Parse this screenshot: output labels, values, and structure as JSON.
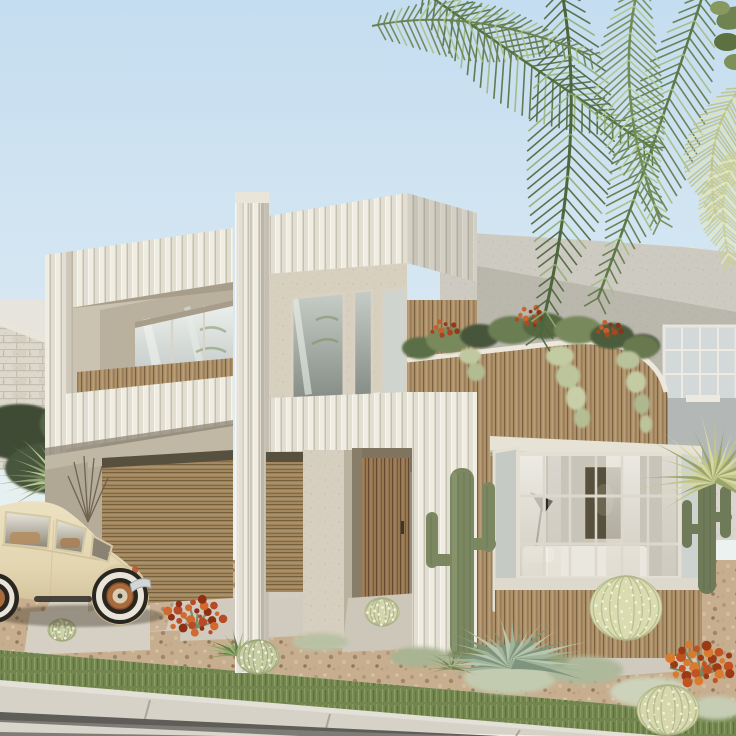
{
  "scene": {
    "type": "architectural-render",
    "description": "Modern two-storey coastal house with white fluted panels, timber slat cladding, recessed balcony, double garage, bay window, desert gravel garden with cacti and agaves, palm fronds overhead and a cream vintage Beetle parked on the driveway",
    "elements": [
      "sky",
      "palm-fronds",
      "neighbour-building-right",
      "brick-wall-left",
      "rear-grey-wall",
      "left-wing-balcony",
      "central-fluted-column",
      "right-wing-parapet",
      "wood-clad-volume",
      "rooftop-garden",
      "garage-doors",
      "entry-door",
      "bay-window",
      "gravel-garden",
      "driveway",
      "lawn-strip",
      "sidewalk",
      "road",
      "saguaro-cactus",
      "agave",
      "barrel-cactus",
      "vintage-beetle-car"
    ]
  },
  "palette": {
    "sky_top": "#c4ddf0",
    "sky_horizon": "#f1f1ea",
    "flute_light": "#efece2",
    "flute_groove": "#c6c0b0",
    "stucco_beige": "#d5cebd",
    "stucco_beige_shade": "#b9b09d",
    "stucco_grey": "#cdcac1",
    "stucco_grey_shade": "#b5b1a8",
    "wood_mid": "#a98d66",
    "wood_dark": "#7a6142",
    "wood_door": "#8f7350",
    "glass_light": "#eef1ef",
    "glass_dark": "#a9b0ab",
    "palm_dark": "#4e663c",
    "palm_light": "#bec487",
    "car_body": "#e4d7b4",
    "rim_copper": "#a86b3c",
    "gravel": "#c7ae8f",
    "concrete": "#d2cdc0",
    "grass": "#73864f",
    "road": "#7e7c76",
    "cactus": "#7b8761",
    "agave": "#9fb49b",
    "flower_red": "#b84a28"
  },
  "generators": {
    "fronds": [
      {
        "p0": [
          418,
          -12
        ],
        "c": [
          515,
          55
        ],
        "p1": [
          652,
          148
        ],
        "len": 40,
        "color": "#56713f",
        "hi": "#9db77e",
        "lw": 2.5
      },
      {
        "p0": [
          560,
          -18
        ],
        "c": [
          590,
          130
        ],
        "p1": [
          540,
          335
        ],
        "len": 46,
        "color": "#4e663c",
        "hi": "#8fae73",
        "lw": 3
      },
      {
        "p0": [
          705,
          -12
        ],
        "c": [
          662,
          125
        ],
        "p1": [
          598,
          298
        ],
        "len": 42,
        "color": "#5f7847",
        "hi": "#a3bc82",
        "lw": 2.5
      },
      {
        "p0": [
          742,
          85
        ],
        "c": [
          700,
          138
        ],
        "p1": [
          716,
          215
        ],
        "len": 30,
        "color": "#bec487",
        "hi": "#e0e2ae",
        "lw": 2
      },
      {
        "p0": [
          372,
          26
        ],
        "c": [
          470,
          5
        ],
        "p1": [
          590,
          55
        ],
        "len": 30,
        "color": "#6a8150",
        "hi": "#a8bf85",
        "lw": 2
      },
      {
        "p0": [
          640,
          -20
        ],
        "c": [
          610,
          90
        ],
        "p1": [
          660,
          220
        ],
        "len": 36,
        "color": "#728b55",
        "hi": "#b0c68c",
        "lw": 2.5
      },
      {
        "p0": [
          741,
          150
        ],
        "c": [
          712,
          190
        ],
        "p1": [
          730,
          262
        ],
        "len": 24,
        "color": "#cbcf9a",
        "hi": "#e6e7bb",
        "lw": 2
      }
    ],
    "rosettes": [
      {
        "target": "rosette-agave-main",
        "cx": 513,
        "cy": 664,
        "n": 26,
        "rmin": 38,
        "rmax": 92,
        "a0": 200,
        "a1": -20,
        "squash": 0.55,
        "w": 11,
        "colors": [
          "#9fb49b",
          "#7e947c",
          "#b7c6ae"
        ]
      },
      {
        "target": "rosette-agave-small",
        "cx": 238,
        "cy": 654,
        "n": 16,
        "rmin": 18,
        "rmax": 44,
        "a0": 195,
        "a1": -15,
        "squash": 0.6,
        "w": 5,
        "colors": [
          "#87a065",
          "#647c49",
          "#9db377"
        ]
      },
      {
        "target": "rosette-yucca-left",
        "cx": 60,
        "cy": 480,
        "n": 24,
        "rmin": 30,
        "rmax": 74,
        "a0": 215,
        "a1": -35,
        "squash": 0.8,
        "w": 6,
        "colors": [
          "#93a377",
          "#6d7f55",
          "#b8c491"
        ]
      },
      {
        "target": "rosette-yucca-right",
        "cx": 716,
        "cy": 480,
        "n": 26,
        "rmin": 36,
        "rmax": 88,
        "a0": 215,
        "a1": -35,
        "squash": 0.85,
        "w": 6,
        "colors": [
          "#c2c68c",
          "#98a566",
          "#d6d7a3"
        ]
      },
      {
        "target": "rosette-grass-1",
        "cx": 452,
        "cy": 668,
        "n": 14,
        "rmin": 14,
        "rmax": 34,
        "a0": 200,
        "a1": -20,
        "squash": 0.7,
        "w": 3,
        "colors": [
          "#8e9c6d",
          "#6f7f52",
          "#a5b180"
        ]
      }
    ],
    "scatters": [
      {
        "target": "flowers-left",
        "cx": 196,
        "cy": 622,
        "n": 26,
        "spread": 30,
        "rdot": [
          2,
          4.5
        ],
        "colors": [
          "#b84a28",
          "#d2692f",
          "#8f3015"
        ],
        "leaves": {
          "n": 8,
          "len": 28,
          "color": "#7b8a60"
        }
      },
      {
        "target": "flowers-right",
        "cx": 700,
        "cy": 670,
        "n": 30,
        "spread": 34,
        "rdot": [
          2.5,
          5
        ],
        "colors": [
          "#c2521f",
          "#d97b2e",
          "#9c3a17"
        ],
        "leaves": {
          "n": 9,
          "len": 32,
          "color": "#75855c"
        }
      },
      {
        "target": "roof-flowers-1",
        "cx": 445,
        "cy": 331,
        "n": 10,
        "spread": 14,
        "rdot": [
          1.5,
          3
        ],
        "colors": [
          "#a8431f",
          "#c06030",
          "#933818"
        ],
        "leaves": null
      },
      {
        "target": "roof-flowers-2",
        "cx": 530,
        "cy": 319,
        "n": 12,
        "spread": 16,
        "rdot": [
          1.5,
          3
        ],
        "colors": [
          "#b04a22",
          "#c86535",
          "#8f3416"
        ],
        "leaves": null
      },
      {
        "target": "roof-flowers-3",
        "cx": 610,
        "cy": 331,
        "n": 10,
        "spread": 13,
        "rdot": [
          1.5,
          3
        ],
        "colors": [
          "#ab4520",
          "#c55f2e",
          "#8d3315"
        ],
        "leaves": null
      }
    ],
    "barrels": [
      {
        "target": "barrel-1",
        "cx": 626,
        "cy": 608,
        "rx": 36,
        "ry": 32,
        "c1": "#dadcb0",
        "c2": "#b0b789",
        "dots": 46
      },
      {
        "target": "barrel-2",
        "cx": 668,
        "cy": 710,
        "rx": 31,
        "ry": 25,
        "c1": "#d6d8ab",
        "c2": "#acb386",
        "dots": 36
      },
      {
        "target": "barrel-3",
        "cx": 258,
        "cy": 657,
        "rx": 21,
        "ry": 17,
        "c1": "#c7cda3",
        "c2": "#9ba478",
        "dots": 24
      },
      {
        "target": "barrel-4",
        "cx": 382,
        "cy": 612,
        "rx": 17,
        "ry": 14,
        "c1": "#d3d6ad",
        "c2": "#a8af82",
        "dots": 20
      },
      {
        "target": "barrel-5",
        "cx": 62,
        "cy": 630,
        "rx": 14,
        "ry": 11,
        "c1": "#ccd1a6",
        "c2": "#a0a87c",
        "dots": 16
      }
    ]
  }
}
